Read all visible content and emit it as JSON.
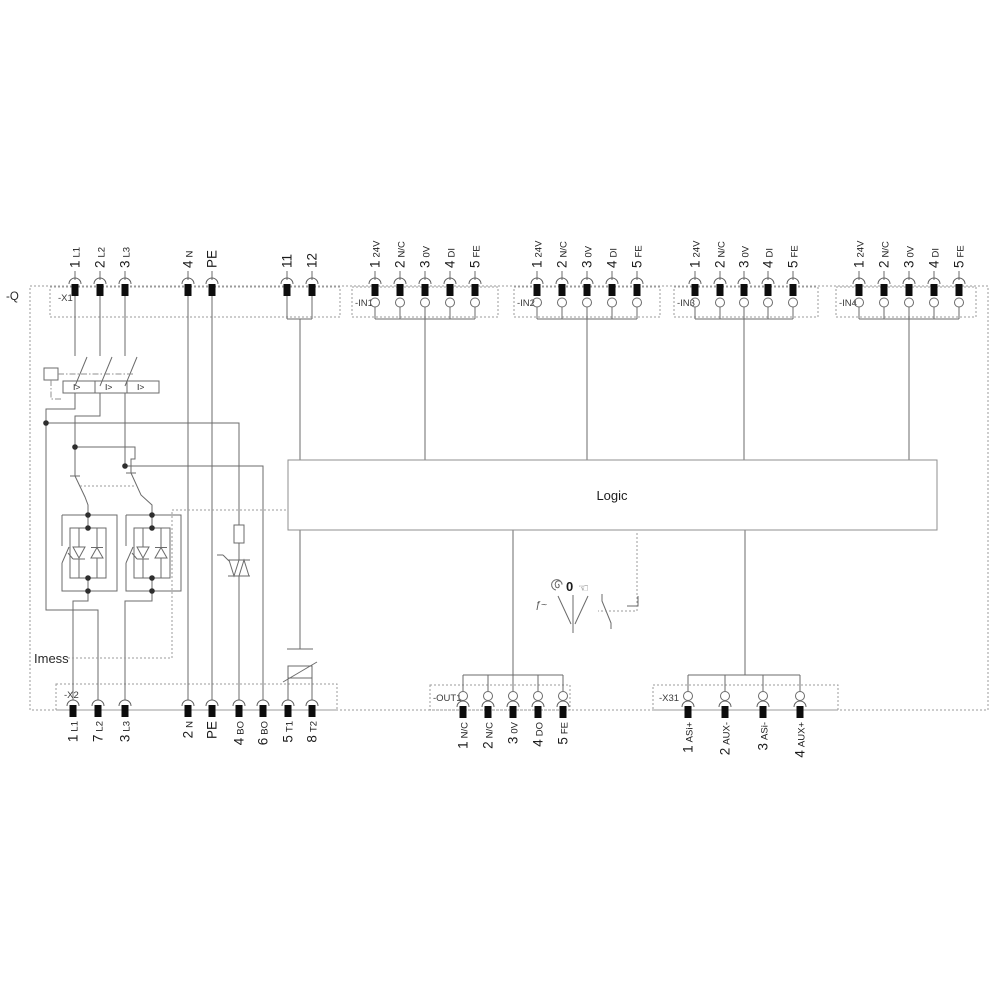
{
  "diagram": {
    "device_label": "-Q",
    "logic_label": "Logic",
    "imess_label": "Imess",
    "overcurrent_label": "I>",
    "selector": {
      "zero": "0",
      "freq": "ƒ~",
      "hand": "☜"
    },
    "colors": {
      "wire": "#6b6b6b",
      "dashed": "#9b9b9b",
      "pin": "#0d0d0d",
      "text": "#1c1c1c",
      "background": "#ffffff"
    }
  },
  "x1": {
    "label": "-X1",
    "pins": [
      {
        "num": "1",
        "name": "L1"
      },
      {
        "num": "2",
        "name": "L2"
      },
      {
        "num": "3",
        "name": "L3"
      },
      {
        "num": "4",
        "name": "N"
      },
      {
        "num": "PE",
        "name": ""
      },
      {
        "num": "11",
        "name": ""
      },
      {
        "num": "12",
        "name": ""
      }
    ]
  },
  "in_blocks": [
    {
      "label": "-IN1"
    },
    {
      "label": "-IN2"
    },
    {
      "label": "-IN3"
    },
    {
      "label": "-IN4"
    }
  ],
  "in_pins": [
    {
      "num": "1",
      "name": "24V"
    },
    {
      "num": "2",
      "name": "N/C"
    },
    {
      "num": "3",
      "name": "0V"
    },
    {
      "num": "4",
      "name": "DI"
    },
    {
      "num": "5",
      "name": "FE"
    }
  ],
  "x2": {
    "label": "-X2",
    "pins": [
      {
        "num": "1",
        "name": "L1"
      },
      {
        "num": "7",
        "name": "L2"
      },
      {
        "num": "3",
        "name": "L3"
      },
      {
        "num": "2",
        "name": "N"
      },
      {
        "num": "PE",
        "name": ""
      },
      {
        "num": "4",
        "name": "BO"
      },
      {
        "num": "6",
        "name": "BO"
      },
      {
        "num": "5",
        "name": "T1"
      },
      {
        "num": "8",
        "name": "T2"
      }
    ]
  },
  "out1": {
    "label": "-OUT1",
    "pins": [
      {
        "num": "1",
        "name": "N/C"
      },
      {
        "num": "2",
        "name": "N/C"
      },
      {
        "num": "3",
        "name": "0V"
      },
      {
        "num": "4",
        "name": "DO"
      },
      {
        "num": "5",
        "name": "FE"
      }
    ]
  },
  "x31": {
    "label": "-X31",
    "pins": [
      {
        "num": "1",
        "name": "ASi+"
      },
      {
        "num": "2",
        "name": "AUX-"
      },
      {
        "num": "3",
        "name": "ASi-"
      },
      {
        "num": "4",
        "name": "AUX+"
      }
    ]
  }
}
